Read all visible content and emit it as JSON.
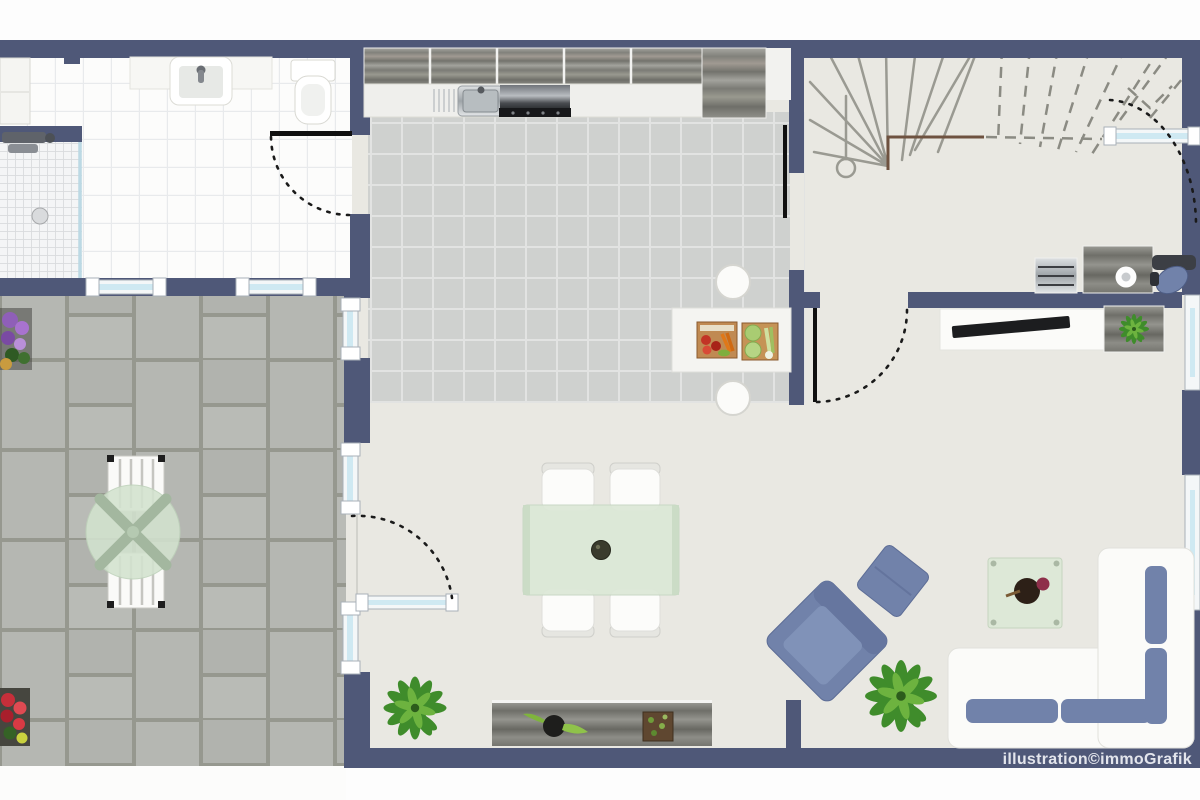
{
  "watermark": "illustration©immoGrafik",
  "colors": {
    "wall": "#4f5878",
    "floor": "#e9e8e2",
    "glass": "#cfe9f2",
    "blue": "#7182aa",
    "greenglass": "#dce8d7"
  },
  "plan": {
    "type": "apartment-ground-floor-plan",
    "rooms": [
      "bathroom",
      "kitchen",
      "dining-area",
      "living-room",
      "stair-hall",
      "terrace"
    ],
    "elements": [
      "shower",
      "washbasin",
      "toilet",
      "bath-cabinet",
      "kitchen-wall-cabinets",
      "kitchen-sink",
      "cooktop",
      "tall-cabinet",
      "kitchen-island",
      "bar-stool",
      "vegetable-crates",
      "dining-table",
      "dining-chair",
      "sideboard",
      "potted-plant",
      "sofa",
      "armchair",
      "ottoman",
      "coffee-table",
      "tv-lowboard",
      "tv",
      "media-cabinet",
      "desk",
      "drawer-unit",
      "office-chair",
      "winder-staircase",
      "walking-line",
      "terrace-table",
      "terrace-chair",
      "flower-planter",
      "window",
      "door-swing"
    ]
  }
}
